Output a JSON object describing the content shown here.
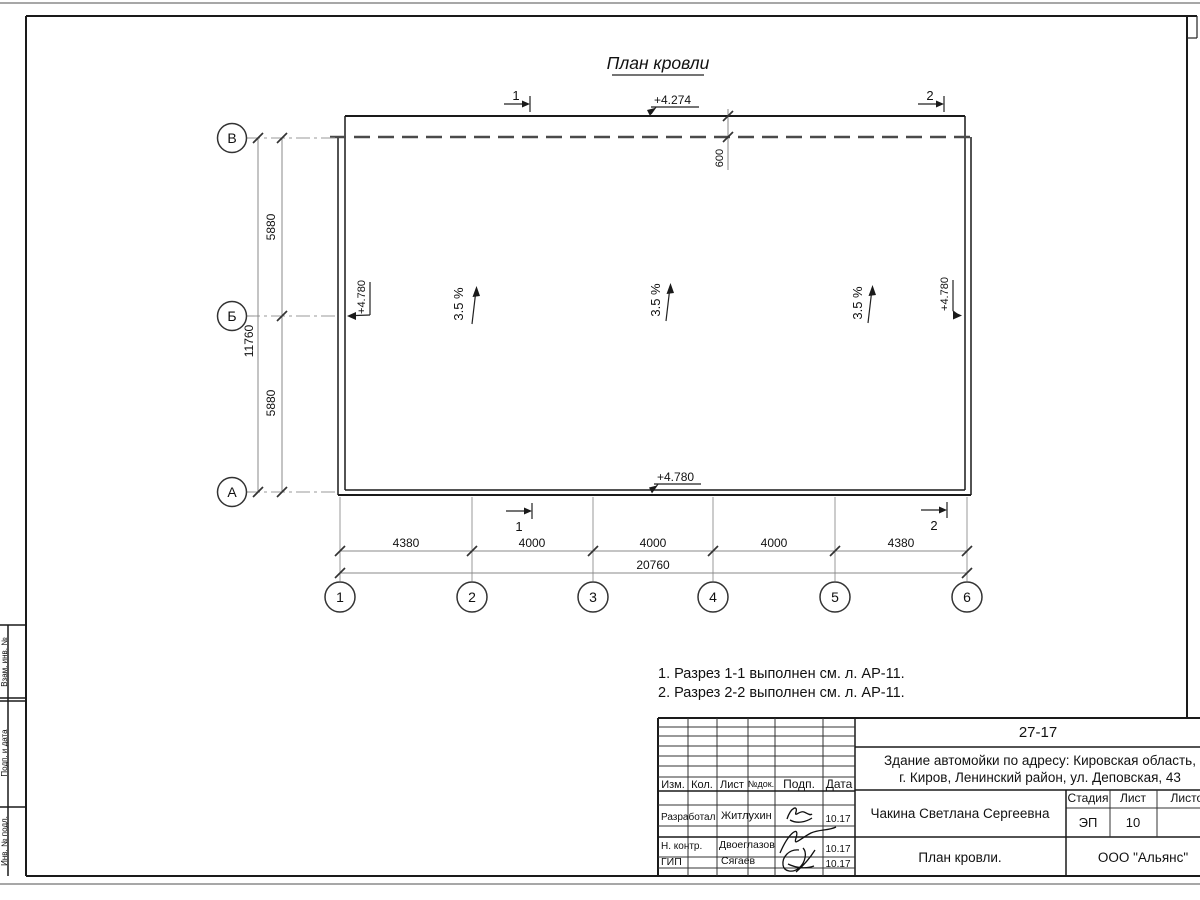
{
  "page": {
    "title": "План кровли"
  },
  "axes": {
    "rows": [
      "В",
      "Б",
      "А"
    ],
    "cols": [
      "1",
      "2",
      "3",
      "4",
      "5",
      "6"
    ]
  },
  "dimensions": {
    "left_segments": [
      "5880",
      "5880"
    ],
    "left_total": "11760",
    "bottom_segments": [
      "4380",
      "4000",
      "4000",
      "4000",
      "4380"
    ],
    "bottom_total": "20760",
    "parapet_offset": "600"
  },
  "elevations": {
    "top": "+4.274",
    "left": "+4.780",
    "right": "+4.780",
    "bottom": "+4.780"
  },
  "slopes": [
    "3.5 %",
    "3.5 %",
    "3.5 %"
  ],
  "sections": {
    "s1": "1",
    "s2": "2"
  },
  "notes": [
    "1. Разрез 1-1 выполнен см. л. АР-11.",
    "2. Разрез 2-2 выполнен см. л. АР-11."
  ],
  "title_block": {
    "doc_number": "27-17",
    "project_line1": "Здание автомойки по адресу: Кировская область,",
    "project_line2": "г. Киров, Ленинский район, ул. Деповская, 43",
    "header": {
      "izm": "Изм.",
      "kol": "Кол.",
      "list": "Лист",
      "ndok": "№док.",
      "podp": "Подп.",
      "data": "Дата"
    },
    "rows": [
      {
        "role": "Разработал",
        "name": "Житлухин",
        "date": "10.17"
      },
      {
        "role": "Н. контр.",
        "name": "Двоеглазов",
        "date": "10.17"
      },
      {
        "role": "ГИП",
        "name": "Сягаев",
        "date": "10.17"
      }
    ],
    "author": "Чакина Светлана Сергеевна",
    "stage_header": {
      "stage": "Стадия",
      "sheet": "Лист",
      "sheets": "Листов"
    },
    "stage": "ЭП",
    "sheet_number": "10",
    "drawing_title": "План кровли.",
    "company": "ООО \"Альянс\""
  },
  "left_strip": {
    "labels": [
      "Взам. инв. №",
      "Подп. и дата",
      "Инв. № подл."
    ]
  },
  "colors": {
    "line": "#1a1a1a",
    "dimension_line": "#888888",
    "axis_line": "#999999",
    "paper": "#ffffff"
  }
}
